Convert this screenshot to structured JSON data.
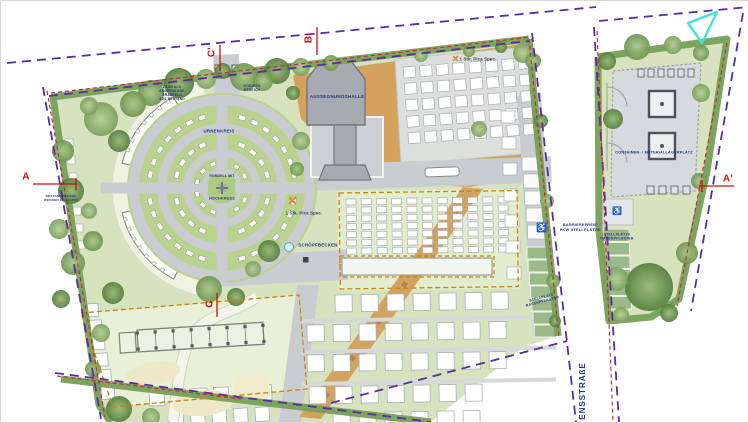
{
  "colors": {
    "boundary_purple": "#5b2da0",
    "boundary_red": "#c82430",
    "field_dash_orange": "#c8860a",
    "label_navy": "#26357e",
    "marker_red": "#cc1111",
    "north_arrow_cyan": "#3fe3d8"
  },
  "labels": {
    "hall": "AUSSEGNUNGSHALLE",
    "urn_circle": "URNENKREIS",
    "circle_center": {
      "line1": "RONDELL MIT",
      "line2": "HOCHKREUZ"
    },
    "basin": "SCHÖPFBECKEN",
    "tree_spec_top": "1 Stk. Pica Spec.",
    "tree_spec_circle": "1 Stk. Pica Spec.",
    "fence_note": {
      "line1": "ZAUN ALS",
      "line2": "ABGRENZUNG",
      "line3": "GRABFELD",
      "line4": "AUS BESTAND"
    },
    "perennial_note": {
      "line1": "STAUDEN",
      "line2": "BEREICH"
    },
    "trees_note": {
      "line1": "BESTANDSBÄUME",
      "line2": "WERDEN ERHALTEN"
    },
    "container_yard": "CONTAINER- / MATERIALLAGERPLATZ",
    "accessible_parking": {
      "line1": "BARRIEREFREIE",
      "line2": "PKW STELLPLÄTZE"
    },
    "parking_main": {
      "line1": "STELLPLATZ",
      "line2": "RASENPFLASTER"
    },
    "parking_parcel": {
      "line1": "STELLPLÄTZE",
      "line2": "RASENPFLASTER"
    }
  },
  "street": {
    "name": "ENSSTRAßE"
  },
  "section_markers": {
    "a": "A",
    "a_prime": "A'",
    "b_prime": "B'",
    "c": "C",
    "c_prime": "C'"
  },
  "icons": {
    "wheelchair": "♿"
  }
}
